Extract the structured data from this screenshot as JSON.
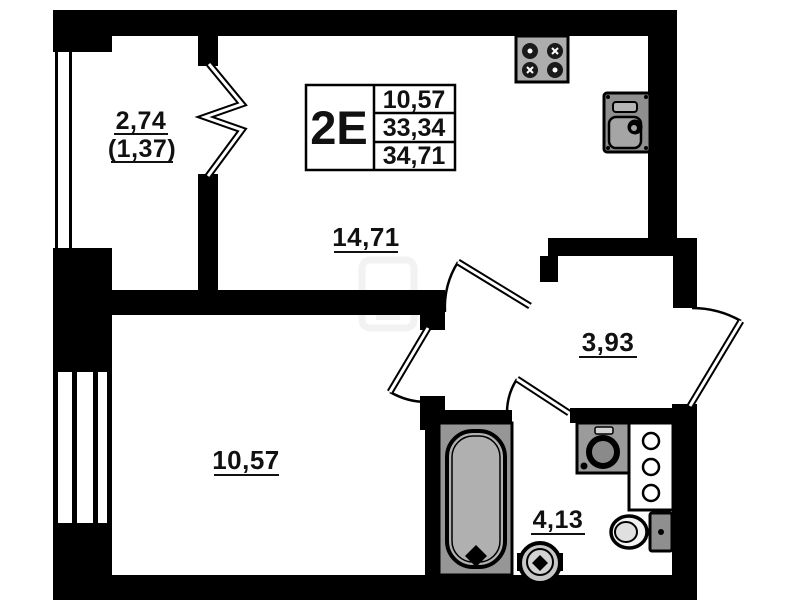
{
  "floor_plan": {
    "unit": {
      "label": "2E",
      "area_table": {
        "living_area": "10,57",
        "floor_area": "33,34",
        "total_area": "34,71"
      }
    },
    "rooms": {
      "balcony": {
        "area": "2,74",
        "reduced_area": "(1,37)"
      },
      "kitchen_living": {
        "area": "14,71"
      },
      "hallway": {
        "area": "3,93"
      },
      "bedroom": {
        "area": "10,57"
      },
      "bathroom": {
        "area": "4,13"
      }
    },
    "fixtures": [
      "stove-icon",
      "kitchen-sink-icon",
      "bathtub-icon",
      "washing-machine-icon",
      "riser-cabinet-icon",
      "toilet-icon",
      "pedestal-sink-icon"
    ],
    "colors": {
      "background": "#ffffff",
      "wall": "#000000",
      "fixture_gray": "#a3a3a3",
      "fixture_light": "#c9c9c9",
      "text": "#111111"
    }
  }
}
